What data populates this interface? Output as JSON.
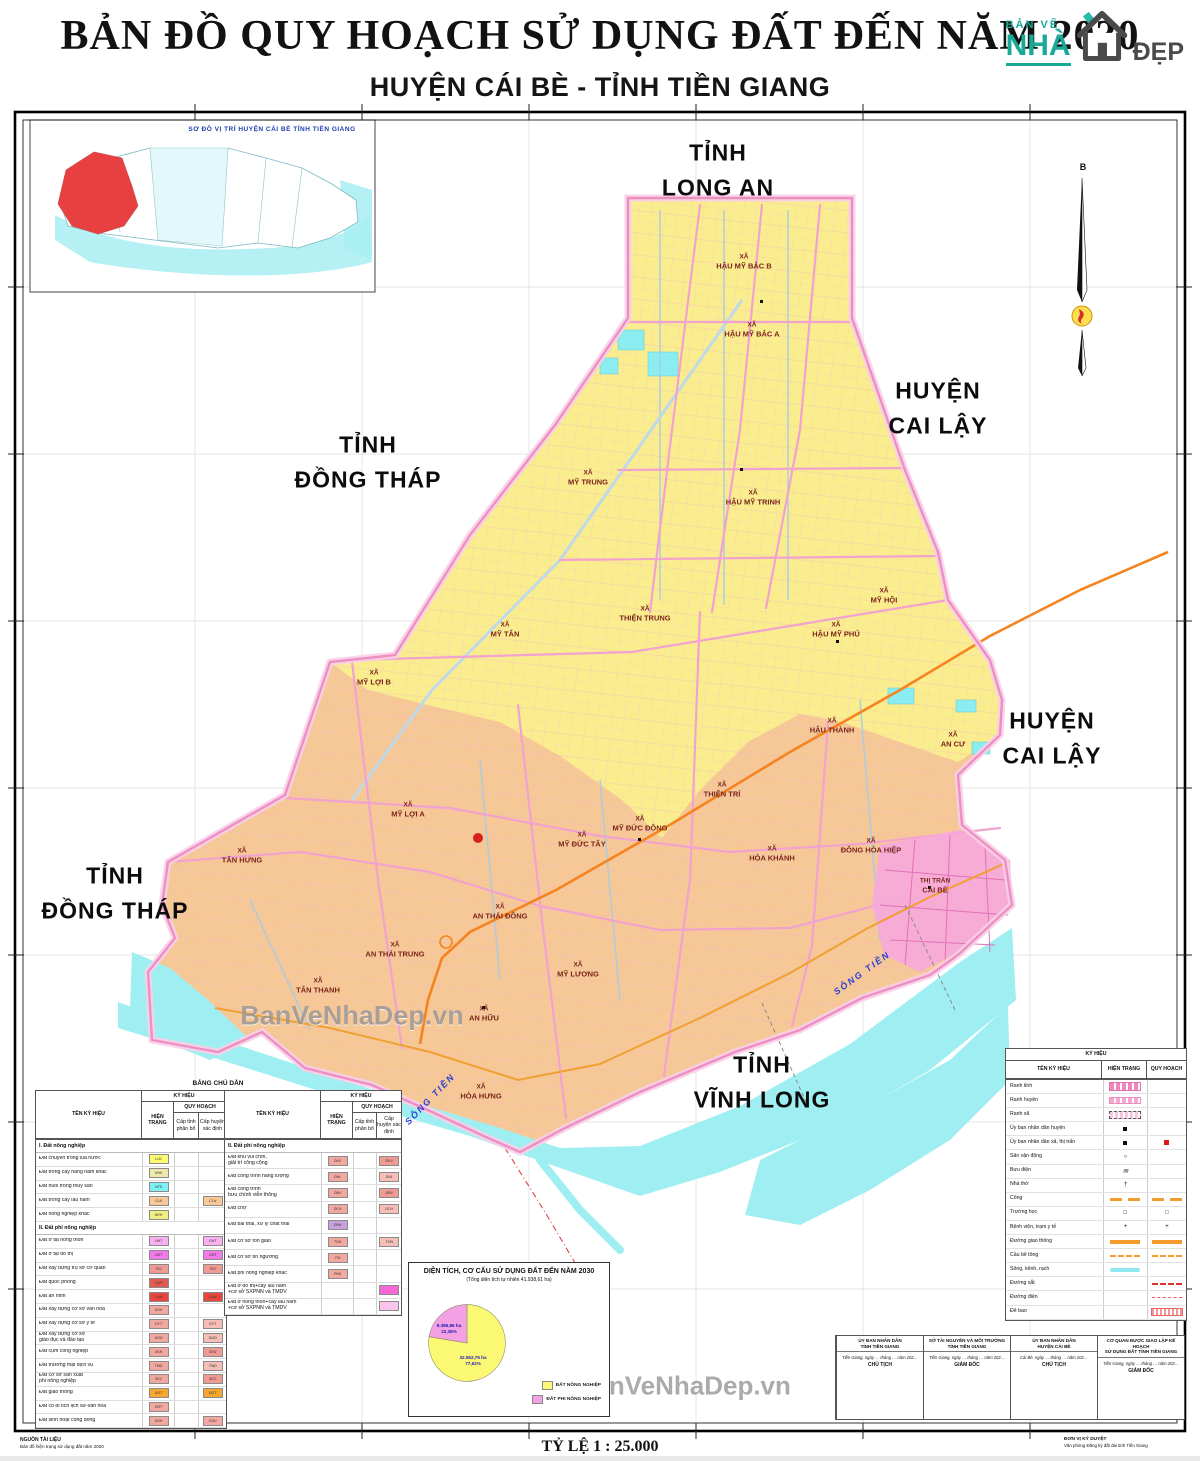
{
  "header": {
    "title": "BẢN ĐỒ QUY HOẠCH SỬ DỤNG ĐẤT ĐẾN NĂM 2030",
    "subtitle": "HUYỆN CÁI BÈ - TỈNH TIỀN GIANG",
    "logo": {
      "line1": "BẢN VẼ",
      "line2": "NHÀ",
      "line3": "ĐẸP"
    }
  },
  "inset": {
    "title": "SƠ ĐỒ VỊ TRÍ HUYỆN CÁI BÈ TỈNH TIỀN GIANG"
  },
  "north": {
    "label": "B"
  },
  "watermark": {
    "map": "BanVeNhaDep.vn",
    "copyright": "Bản quyền © BanVeNhaDep.vn"
  },
  "colors": {
    "north_region": "#FAED8E",
    "south_region": "#F6C896",
    "water": "#9FEFF2",
    "road": "#F2A2CE",
    "boundary": "#EE8FC4",
    "expressway": "#F5831F",
    "urban": "#F6A8DC",
    "district_red": "#E84040"
  },
  "region_labels": [
    {
      "text": "TỈNH\nLONG AN",
      "x": 718,
      "y": 170
    },
    {
      "text": "HUYỆN\nCAI LẬY",
      "x": 938,
      "y": 408
    },
    {
      "text": "TỈNH\nĐỒNG THÁP",
      "x": 368,
      "y": 462
    },
    {
      "text": "HUYỆN\nCAI LẬY",
      "x": 1052,
      "y": 738
    },
    {
      "text": "TỈNH\nĐỒNG THÁP",
      "x": 115,
      "y": 893
    },
    {
      "text": "TỈNH\nVĨNH LONG",
      "x": 762,
      "y": 1082
    }
  ],
  "communes": [
    {
      "l1": "XÃ",
      "l2": "HẬU MỸ BẮC B",
      "x": 744,
      "y": 262
    },
    {
      "l1": "XÃ",
      "l2": "HẬU MỸ BẮC A",
      "x": 752,
      "y": 330
    },
    {
      "l1": "XÃ",
      "l2": "MỸ TRUNG",
      "x": 588,
      "y": 478
    },
    {
      "l1": "XÃ",
      "l2": "HẬU MỸ TRINH",
      "x": 753,
      "y": 498
    },
    {
      "l1": "XÃ",
      "l2": "MỸ HỘI",
      "x": 884,
      "y": 596
    },
    {
      "l1": "XÃ",
      "l2": "MỸ TÂN",
      "x": 505,
      "y": 630
    },
    {
      "l1": "XÃ",
      "l2": "THIỆN TRUNG",
      "x": 645,
      "y": 614
    },
    {
      "l1": "XÃ",
      "l2": "HẬU MỸ PHÚ",
      "x": 836,
      "y": 630
    },
    {
      "l1": "XÃ",
      "l2": "MỸ LỢI B",
      "x": 374,
      "y": 678
    },
    {
      "l1": "XÃ",
      "l2": "HẬU THÀNH",
      "x": 832,
      "y": 726
    },
    {
      "l1": "XÃ",
      "l2": "AN CƯ",
      "x": 953,
      "y": 740
    },
    {
      "l1": "XÃ",
      "l2": "MỸ LỢI A",
      "x": 408,
      "y": 810
    },
    {
      "l1": "XÃ",
      "l2": "THIỆN TRÍ",
      "x": 722,
      "y": 790
    },
    {
      "l1": "XÃ",
      "l2": "MỸ ĐỨC TÂY",
      "x": 582,
      "y": 840
    },
    {
      "l1": "XÃ",
      "l2": "MỸ ĐỨC ĐÔNG",
      "x": 640,
      "y": 824
    },
    {
      "l1": "XÃ",
      "l2": "HÒA KHÁNH",
      "x": 772,
      "y": 854
    },
    {
      "l1": "XÃ",
      "l2": "ĐÔNG HÒA HIỆP",
      "x": 871,
      "y": 846
    },
    {
      "l1": "THỊ TRẤN",
      "l2": "CÁI BÈ",
      "x": 935,
      "y": 886
    },
    {
      "l1": "XÃ",
      "l2": "TÂN HƯNG",
      "x": 242,
      "y": 856
    },
    {
      "l1": "XÃ",
      "l2": "AN THÁI ĐÔNG",
      "x": 500,
      "y": 912
    },
    {
      "l1": "XÃ",
      "l2": "AN THÁI TRUNG",
      "x": 395,
      "y": 950
    },
    {
      "l1": "XÃ",
      "l2": "TÂN THANH",
      "x": 318,
      "y": 986
    },
    {
      "l1": "XÃ",
      "l2": "MỸ LƯƠNG",
      "x": 578,
      "y": 970
    },
    {
      "l1": "XÃ",
      "l2": "AN HỮU",
      "x": 484,
      "y": 1014
    },
    {
      "l1": "XÃ",
      "l2": "HÒA HƯNG",
      "x": 481,
      "y": 1092
    }
  ],
  "river_labels": [
    {
      "text": "SÔNG TIỀN",
      "x": 862,
      "y": 972,
      "rot": "rotate(-36deg)"
    },
    {
      "text": "SÔNG TIỀN",
      "x": 430,
      "y": 1098,
      "rot": "rotate(-46deg)"
    }
  ],
  "legend": {
    "caption": "BẢNG CHÚ DẪN",
    "headers": {
      "ky_hieu": "KÝ HIỆU",
      "ten_ky_hieu": "TÊN KÝ HIỆU",
      "hien_trang": "HIỆN TRẠNG",
      "quy_hoach": "QUY HOẠCH",
      "cap_tinh": "Cấp tỉnh phân bổ",
      "cap_huyen": "Cấp huyện xác định"
    },
    "table1": {
      "section1": {
        "title": "I. Đất nông nghiệp",
        "rows": [
          {
            "name": "Đất chuyên trồng lúa nước",
            "code": "LUC",
            "ht": "#FCFA6E"
          },
          {
            "name": "Đất trồng cây hàng năm khác",
            "code": "HNK",
            "ht": "#EEE8AA"
          },
          {
            "name": "Đất nuôi trồng thủy sản",
            "code": "NTS",
            "ht": "#7DF2F2"
          },
          {
            "name": "Đất trồng cây lâu năm",
            "code": "CLN",
            "ht": "#F8C996",
            "qh": "#F8C996"
          },
          {
            "name": "Đất nông nghiệp khác",
            "code": "NKH",
            "ht": "#F0EE80"
          }
        ]
      },
      "section2": {
        "title": "II. Đất phi nông nghiệp",
        "rows": [
          {
            "name": "Đất ở tại nông thôn",
            "code": "ONT",
            "ht": "#F8B0F0",
            "qh": "#F8B0F0"
          },
          {
            "name": "Đất ở tại đô thị",
            "code": "ODT",
            "ht": "#F279E8",
            "qh": "#F279E8"
          },
          {
            "name": "Đất xây dựng trụ sở cơ quan",
            "code": "TSC",
            "ht": "#F09A94",
            "qh": "#F09A94"
          },
          {
            "name": "Đất quốc phòng",
            "code": "CQP",
            "ht": "#E25B50"
          },
          {
            "name": "Đất an ninh",
            "code": "CAN",
            "ht": "#E8463C",
            "qh": "#E8463C"
          },
          {
            "name": "Đất xây dựng cơ sở văn hóa",
            "code": "DVH",
            "ht": "#F2A89E"
          },
          {
            "name": "Đất xây dựng cơ sở y tế",
            "code": "DYT",
            "ht": "#F2A89E",
            "qh": "#F6BEB6"
          },
          {
            "name": "Đất xây dựng cơ sở\ngiáo dục và đào tạo",
            "code": "DGD",
            "ht": "#F2A89E",
            "qh": "#F6BEB6"
          },
          {
            "name": "Đất cụm công nghiệp",
            "code": "SKN",
            "ht": "#F2A89E",
            "qh": "#F09A94"
          },
          {
            "name": "Đất thương mại dịch vụ",
            "code": "TMD",
            "ht": "#F2A89E",
            "qh": "#F6BEB6"
          },
          {
            "name": "Đất cơ sở sản xuất\nphi nông nghiệp",
            "code": "SKC",
            "ht": "#F2A89E",
            "qh": "#F09A94"
          },
          {
            "name": "Đất giao thông",
            "code": "DGT",
            "ht": "#F5A82D",
            "qh": "#F5A82D"
          },
          {
            "name": "Đất có di tích lịch sử-văn hóa",
            "code": "DDT",
            "ht": "#F2A89E"
          },
          {
            "name": "Đất sinh hoạt cộng đồng",
            "code": "DSH",
            "ht": "#F2A89E",
            "qh": "#F4A8A0"
          }
        ]
      }
    },
    "table2": {
      "section": {
        "title": "II. Đất phi nông nghiệp",
        "rows": [
          {
            "name": "Đất khu vui chơi,\ngiải trí công cộng",
            "code": "DKV",
            "ht": "#F2A89E",
            "qh": "#F09A94"
          },
          {
            "name": "Đất công trình năng lượng",
            "code": "DNL",
            "ht": "#F2A89E",
            "qh": "#F6BEB6"
          },
          {
            "name": "Đất công trình\nbưu chính viễn thông",
            "code": "DBV",
            "ht": "#F2A89E",
            "qh": "#F09A94"
          },
          {
            "name": "Đất chợ",
            "code": "DCH",
            "ht": "#F2A89E",
            "qh": "#F6BEB6"
          },
          {
            "name": "Đất bãi thải, xử lý chất thải",
            "code": "DRA",
            "ht": "#C9A0DC"
          },
          {
            "name": "Đất cơ sở tôn giáo",
            "code": "TON",
            "ht": "#F2A89E",
            "qh": "#F6BEB6"
          },
          {
            "name": "Đất cơ sở tín ngưỡng",
            "code": "TIN",
            "ht": "#F2A89E"
          },
          {
            "name": "Đất phi nông nghiệp khác",
            "code": "PNK",
            "ht": "#F2A89E"
          },
          {
            "name": "Đất ở đô thị+cây lâu năm\n+cơ sở SXPNN và TMDV",
            "code": "",
            "qh": "#F668D8"
          },
          {
            "name": "Đất ở nông thôn+cây lâu năm\n+cơ sở SXPNN và TMDV",
            "code": "",
            "qh": "#FBC4EC"
          }
        ]
      }
    }
  },
  "symbols": {
    "caption": "KÝ HIỆU",
    "headers": {
      "ten_ky_hieu": "TÊN KÝ HIỆU",
      "hien_trang": "HIỆN TRẠNG",
      "quy_hoach": "QUY HOẠCH"
    },
    "rows": [
      {
        "name": "Ranh tỉnh",
        "ht": "s-ranh-tinh"
      },
      {
        "name": "Ranh huyện",
        "ht": "s-ranh-huyen"
      },
      {
        "name": "Ranh xã",
        "ht": "s-ranh-xa"
      },
      {
        "name": "Ủy ban nhân dân huyện",
        "ht": "s-dot-black"
      },
      {
        "name": "Ủy ban nhân dân xã, thị trấn",
        "ht": "s-dot-black",
        "qh": "s-dot-red"
      },
      {
        "name": "Sân vận động",
        "htg": "○"
      },
      {
        "name": "Bưu điện",
        "htg": "✉"
      },
      {
        "name": "Nhà thờ",
        "htg": "†"
      },
      {
        "name": "Cống",
        "ht": "s-cong",
        "qh": "s-cong"
      },
      {
        "name": "Trường học",
        "htg": "□",
        "qhg": "□"
      },
      {
        "name": "Bệnh viện, trạm y tế",
        "htg": "+",
        "qhg": "+"
      },
      {
        "name": "Đường giao thông",
        "ht": "s-bar-orange",
        "qh": "s-bar-orange"
      },
      {
        "name": "Cầu bê tông",
        "ht": "s-dash-orange",
        "qh": "s-dash-orange"
      },
      {
        "name": "Sông, kênh, rạch",
        "ht": "s-river"
      },
      {
        "name": "Đường sắt",
        "qh": "s-rail"
      },
      {
        "name": "Đường điện",
        "qh": "s-dash-red"
      },
      {
        "name": "Đê bao",
        "qh": "s-hatch-red"
      }
    ]
  },
  "signatures": [
    {
      "title": "ỦY BAN NHÂN DÂN\nTỈNH TIỀN GIANG",
      "date": "Tiền Giang, ngày … tháng … năm 202…",
      "role": "CHỦ TỊCH"
    },
    {
      "title": "SỞ TÀI NGUYÊN VÀ MÔI TRƯỜNG\nTỈNH TIỀN GIANG",
      "date": "Tiền Giang, ngày … tháng … năm 202…",
      "role": "GIÁM ĐỐC"
    },
    {
      "title": "ỦY BAN NHÂN DÂN\nHUYỆN CÁI BÈ",
      "date": "Cái Bè, ngày … tháng … năm 202…",
      "role": "CHỦ TỊCH"
    },
    {
      "title": "CƠ QUAN ĐƯỢC GIAO LẬP KẾ HOẠCH\nSỬ DỤNG ĐẤT TỈNH TIỀN GIANG",
      "date": "Tiền Giang, ngày … tháng … năm 202…",
      "role": "GIÁM ĐỐC"
    }
  ],
  "chart": {
    "title": "DIỆN TÍCH, CƠ CẤU SỬ DỤNG ĐẤT ĐẾN NĂM 2030",
    "subtitle": "(Tổng diện tích tự nhiên 41.938,61 ha)",
    "slice_agri_color": "#FBF873",
    "slice_nonagri_color": "#F4A0E4",
    "label_agri": "32.552,75 ha\n77,62%",
    "label_nonagri": "9.385,86 ha\n22,38%",
    "legend_agri": "ĐẤT NÔNG NGHIỆP",
    "legend_nonagri": "ĐẤT PHI NÔNG NGHIỆP"
  },
  "chart_data": {
    "type": "pie",
    "title": "DIỆN TÍCH, CƠ CẤU SỬ DỤNG ĐẤT ĐẾN NĂM 2030",
    "subtitle": "(Tổng diện tích tự nhiên 41.938,61 ha)",
    "labels": [
      "ĐẤT NÔNG NGHIỆP",
      "ĐẤT PHI NÔNG NGHIỆP"
    ],
    "values_pct": [
      77.62,
      22.38
    ],
    "values_ha": [
      "32.552,75",
      "9.385,86"
    ],
    "total_ha": "41.938,61",
    "colors": [
      "#FBF873",
      "#F4A0E4"
    ],
    "legend_position": "bottom-right"
  },
  "footer": {
    "source_label": "NGUỒN TÀI LIỆU",
    "source": "Bản đồ hiện trạng sử dụng đất năm 2020",
    "scale": "TỶ LỆ 1 : 25.000",
    "right1": "ĐƠN VỊ KÝ DUYỆT",
    "right2": "Văn phòng Đăng ký đất đai tỉnh Tiền Giang"
  }
}
